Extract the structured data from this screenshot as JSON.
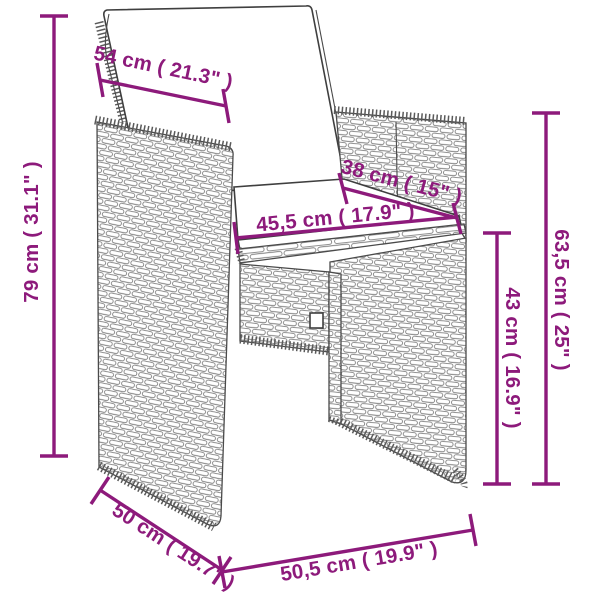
{
  "diagram": {
    "type": "product-dimension-diagram",
    "subject": "poly-rattan cube chair with back and seat cushions",
    "accent_color": "#8d1a7b",
    "outline_color": "#3f3f3f",
    "background": "#ffffff",
    "dimensions": [
      {
        "id": "backrest-width",
        "label": "54 cm ( 21.3\" )"
      },
      {
        "id": "overall-height",
        "label": "79 cm ( 31.1\" )"
      },
      {
        "id": "seat-depth",
        "label": "38 cm ( 15\" )"
      },
      {
        "id": "seat-width",
        "label": "45,5 cm ( 17.9\" )"
      },
      {
        "id": "seat-height",
        "label": "43 cm ( 16.9\" )"
      },
      {
        "id": "armrest-height",
        "label": "63,5 cm ( 25\" )"
      },
      {
        "id": "overall-depth",
        "label": "50 cm ( 19.7\" )"
      },
      {
        "id": "overall-width",
        "label": "50,5 cm ( 19.9\" )"
      }
    ]
  }
}
